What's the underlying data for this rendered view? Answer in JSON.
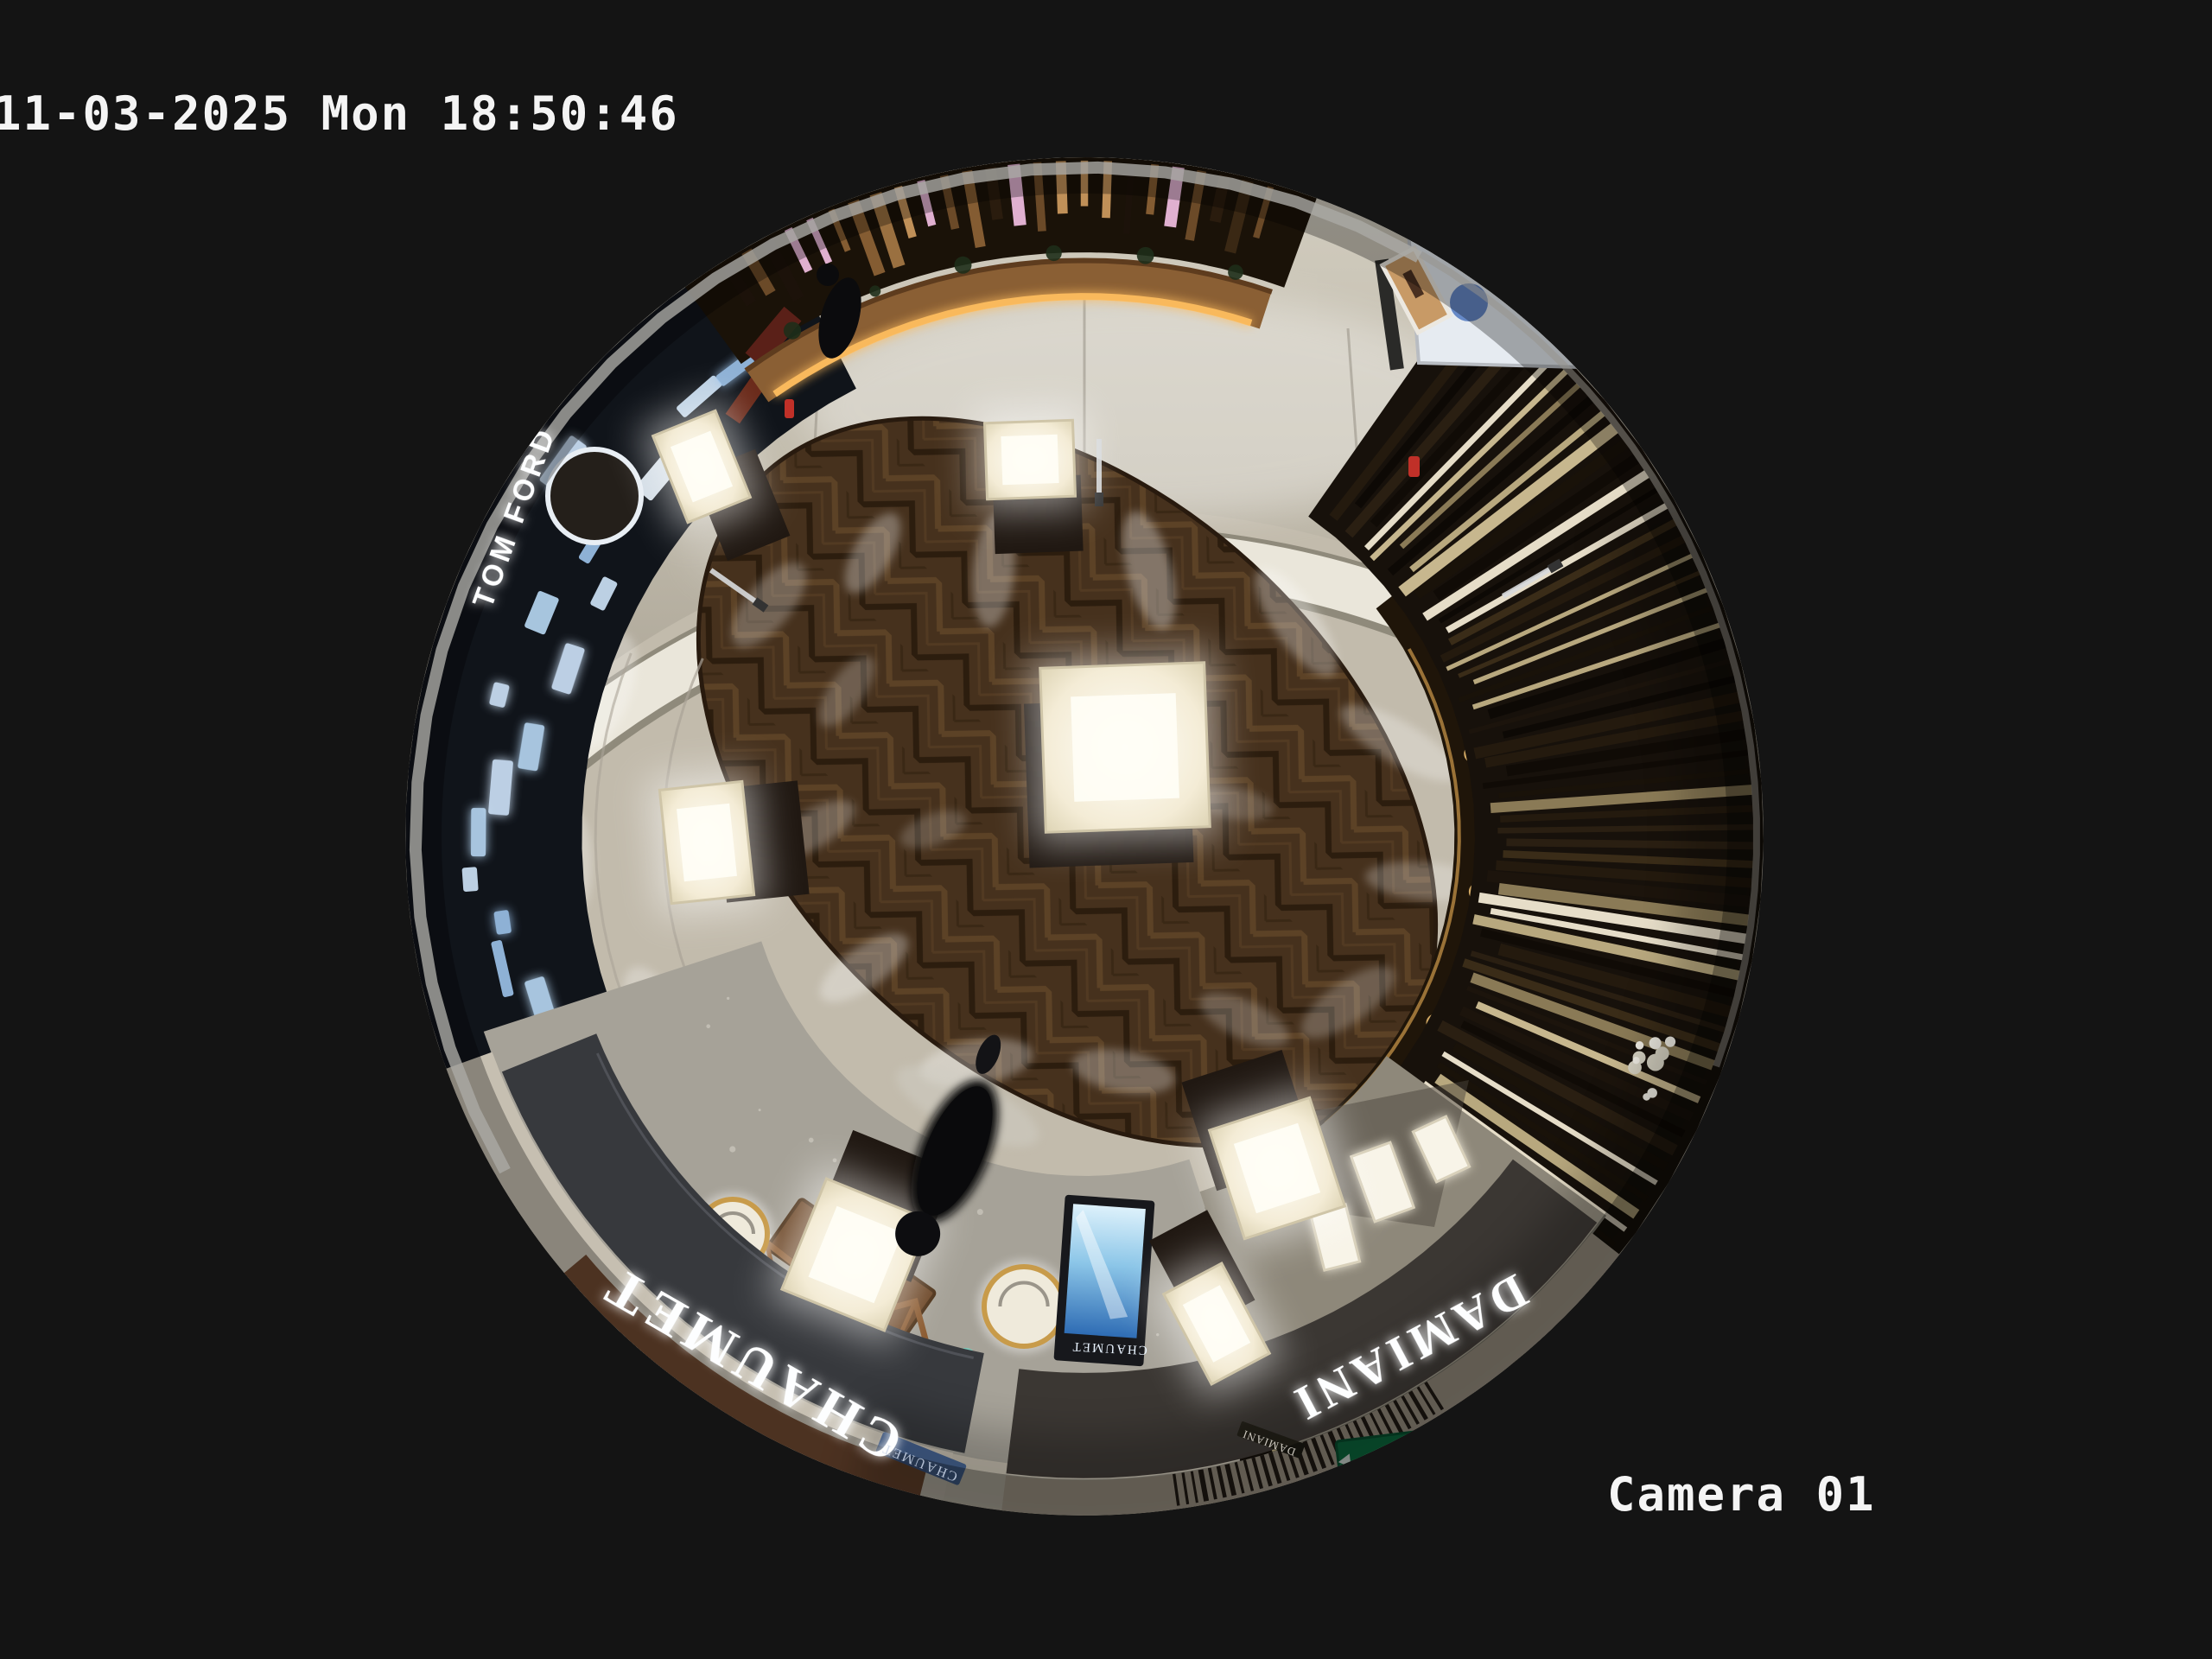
{
  "osd": {
    "timestamp": "11-03-2025 Mon 18:50:46",
    "camera_label": "Camera 01"
  },
  "signs": {
    "chaumet": "CHAUMET",
    "damiani": "DAMIANI",
    "tom_ford": "TOM FORD",
    "chaumet_screen": "CHAUMET",
    "chaumet_plaque": "CHAUMET",
    "damiani_plaque": "DAMIANI",
    "exit": "EXIT"
  },
  "colors": {
    "background": "#141414",
    "osd_text": "#f4f4f4",
    "walkway": "#c2bbac",
    "wood_floor": "#46311d",
    "fascia": "#37393d",
    "fascia_right": "#3b3733",
    "sign_text": "#fdfeff",
    "desk_led": "#ffbe5e",
    "exit_green": "#0f7a48",
    "screen_blue": "#2e6cb4",
    "terrazzo": "#a6a298",
    "slat_dark": "#1a1208"
  }
}
